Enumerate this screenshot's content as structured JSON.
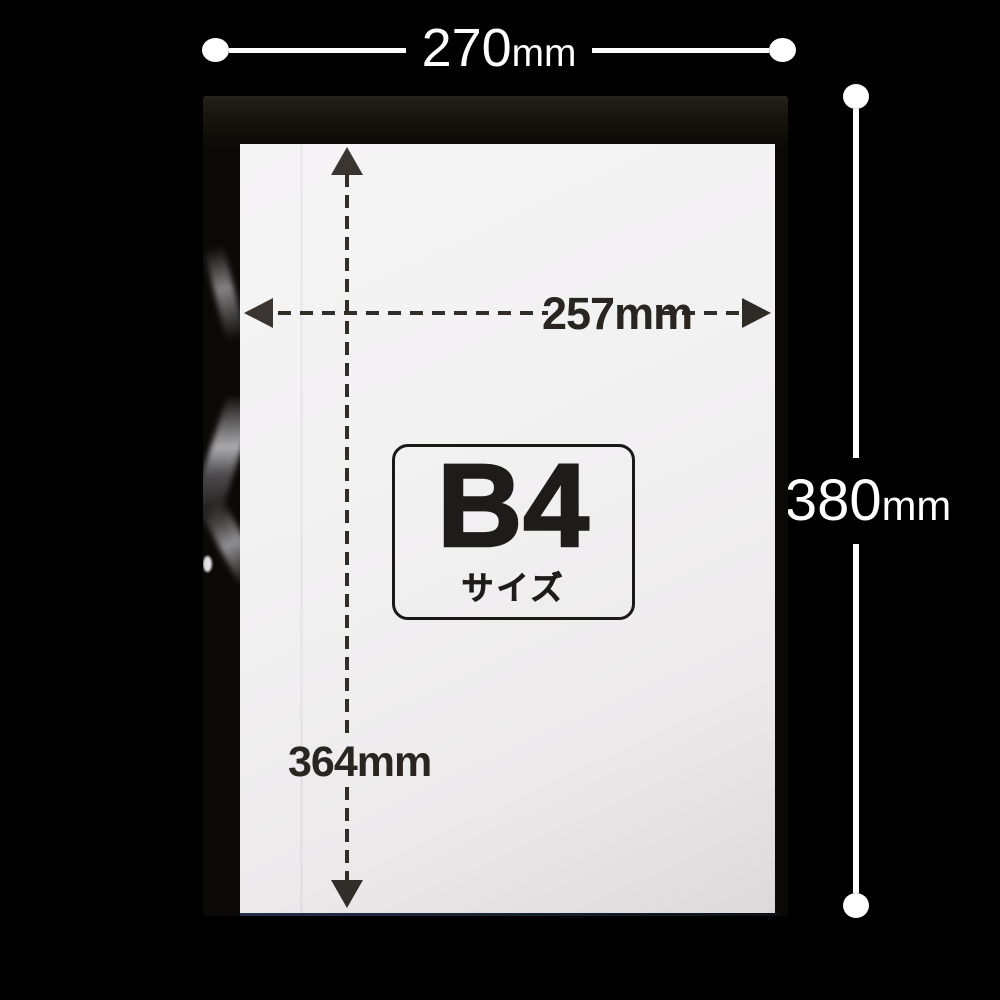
{
  "labels": {
    "outer_width": {
      "value": "270",
      "unit": "mm"
    },
    "outer_height": {
      "value": "380",
      "unit": "mm"
    },
    "inner_width": "257mm",
    "inner_height": "364mm",
    "size": {
      "main": "B4",
      "caption": "サイズ"
    }
  },
  "icons": {
    "endpoint": "round-dot",
    "inner_arrows": "solid-triangle"
  },
  "colors": {
    "background": "#000000",
    "annotation_white": "#ffffff",
    "annotation_dark": "#312d28",
    "paper": "#f2f1f2",
    "bag_film": "#0b0906",
    "bag_bottom_edge": "#223049",
    "size_box_border": "#191918"
  }
}
